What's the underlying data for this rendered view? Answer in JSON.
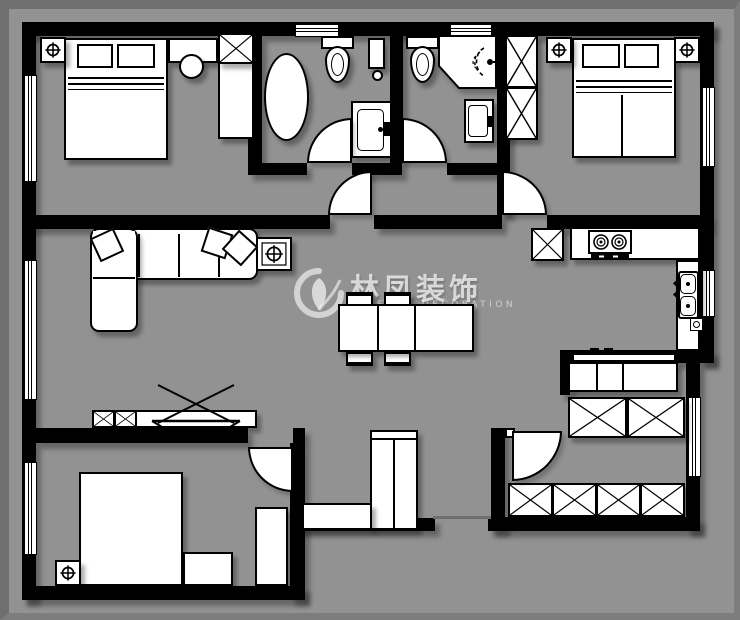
{
  "watermark": {
    "title": "林凤装饰",
    "subtitle": "LINFENG DECORATION",
    "logo": "swirl-leaf-logo"
  },
  "colors": {
    "canvas": "#929292",
    "frame": "#6f6f6f",
    "wall": "#000000",
    "fixture_fill": "#ffffff",
    "outline": "#000000",
    "shadow": "rgba(0,0,0,0.32)",
    "watermark_text": "rgba(255,255,255,0.70)"
  },
  "plan": {
    "type": "apartment-floor-plan",
    "rooms": [
      {
        "name": "bedroom-top-left",
        "fixtures": [
          "ceiling-light",
          "double-bed",
          "pillows",
          "dresser-with-lamp",
          "wardrobe-x",
          "window-left",
          "window-opening"
        ]
      },
      {
        "name": "bathroom-left",
        "fixtures": [
          "bathtub",
          "toilet",
          "wall-shelf",
          "washbasin",
          "swing-door",
          "window-top"
        ]
      },
      {
        "name": "bathroom-right",
        "fixtures": [
          "toilet",
          "corner-shower",
          "washbasin",
          "swing-door",
          "window-top"
        ]
      },
      {
        "name": "bedroom-top-right",
        "fixtures": [
          "wardrobe-x-2",
          "ceiling-light",
          "ceiling-light",
          "double-bed",
          "pillows",
          "swing-door",
          "window-right"
        ]
      },
      {
        "name": "living-dining",
        "fixtures": [
          "corner-sofa",
          "throw-pillows",
          "ceiling-light",
          "dining-table",
          "four-chairs",
          "tv-stand-x",
          "tv-symbol",
          "hall-swing-door",
          "window-left"
        ]
      },
      {
        "name": "kitchen",
        "fixtures": [
          "fridge-x",
          "counter",
          "gas-stove-2-burner",
          "double-basin-sink",
          "floor-drain",
          "window-right"
        ]
      },
      {
        "name": "bedroom-bottom-left",
        "fixtures": [
          "double-bed",
          "nightstand",
          "tall-cabinet",
          "ceiling-light",
          "swing-door",
          "window-left"
        ]
      },
      {
        "name": "hallway",
        "fixtures": [
          "l-shaped-cabinet",
          "threshold"
        ]
      },
      {
        "name": "study-entry",
        "fixtures": [
          "desk",
          "desk-items",
          "wardrobe-x-2",
          "shoe-cabinet-x-4",
          "entry-swing-door",
          "window-right"
        ]
      }
    ]
  }
}
